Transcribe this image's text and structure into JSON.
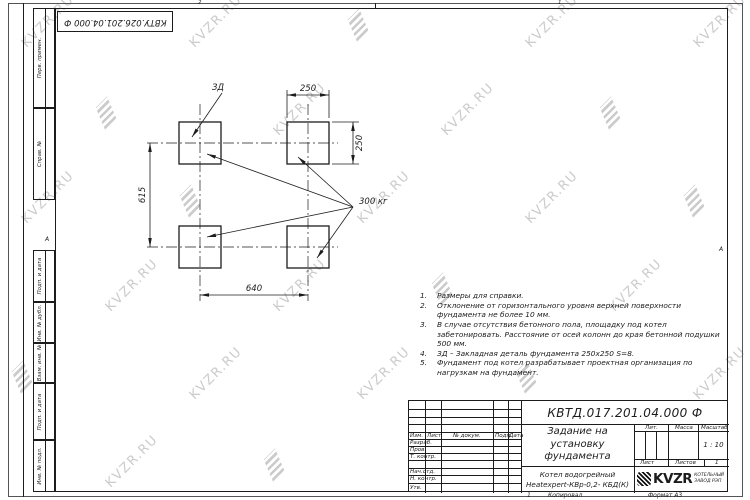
{
  "sheet": {
    "top_stamp": "КВТУ.026.201.04.000 Ф",
    "zone_top_left_num": "2",
    "zone_top_right_num": "1",
    "zone_left_letter": "А",
    "zone_right_letter": "А",
    "zone_bottom_num": "1",
    "footer_copied": "Копировал",
    "footer_format": "Формат А3"
  },
  "margin_labels": [
    "Перв. примен.",
    "Справ. №",
    "Подп. и дата",
    "Инв. № дубл.",
    "Взам. инв. №",
    "Подп. и дата",
    "Инв. № подл."
  ],
  "drawing": {
    "embed_label": "ЗД",
    "load_label": "300 кг",
    "dim_width_top": "250",
    "dim_height_right": "250",
    "dim_span_left": "615",
    "dim_span_bottom": "640"
  },
  "notes": [
    {
      "n": "1.",
      "text": "Размеры для справки."
    },
    {
      "n": "2.",
      "text": "Отклонение от горизонтального уровня верхней поверхности фундамента не более 10 мм."
    },
    {
      "n": "3.",
      "text": "В случае отсутствия бетонного пола, площадку под котел забетонировать. Расстояние от осей колонн до края бетонной подушки 500 мм."
    },
    {
      "n": "4.",
      "text": "ЗД – Закладная деталь фундамента 250х250 S=8."
    },
    {
      "n": "5.",
      "text": "Фундамент под котел разрабатывает проектная организация по нагрузкам на фундамент."
    }
  ],
  "title_block": {
    "designation": "КВТД.017.201.04.000 Ф",
    "doc_title_line1": "Задание на установку",
    "doc_title_line2": "фундамента",
    "cols": [
      "Изм.",
      "Лист",
      "№ докум.",
      "Подп.",
      "Дата"
    ],
    "rows": [
      "Разраб.",
      "Пров.",
      "Т. контр.",
      "",
      "Нач.отд.",
      "Н. контр.",
      "Утв."
    ],
    "lit": "Лит.",
    "mass": "Масса",
    "scale": "Масштаб",
    "scale_value": "1 : 10",
    "sheet": "Лист",
    "sheets": "Листов",
    "sheets_value": "1",
    "product_line1": "Котел водогрейный",
    "product_line2": "Heatexpert-КВр-0,2- КБД(К)",
    "org_logo_text": "KVZR",
    "org_name_line1": "КОТЕЛЬНЫЙ",
    "org_name_line2": "ЗАВОД РЭП"
  },
  "watermark": {
    "text": "KVZR.RU",
    "color": "#cbcbcb"
  }
}
